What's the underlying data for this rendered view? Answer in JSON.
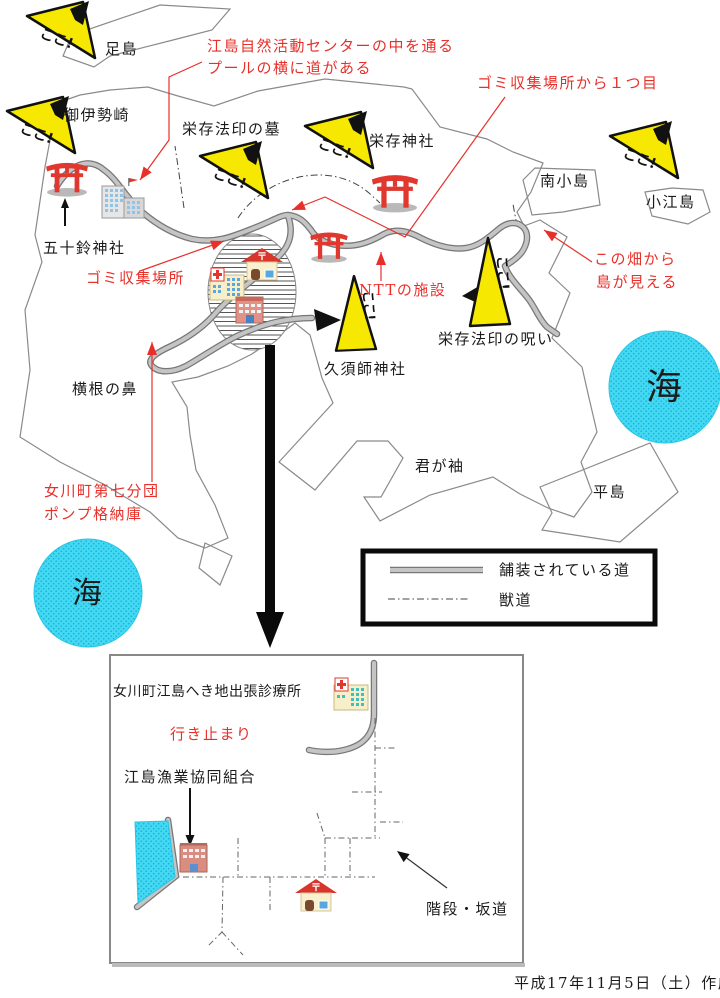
{
  "meta": {
    "created": "平成17年11月5日（土）作成"
  },
  "sea_label": "海",
  "flag_label": "ここ!",
  "post_mark": "〒",
  "legend": {
    "paved": "舗装されている道",
    "trail": "獣道"
  },
  "places": {
    "ashijima": "足島",
    "oisezaki": "御伊勢崎",
    "eizon_grave": "栄存法印の墓",
    "eizon_shrine": "栄存神社",
    "minami_kojima": "南小島",
    "koejima": "小江島",
    "isuzu_shrine": "五十鈴神社",
    "eizon_curse": "栄存法印の呪い",
    "kusushi_shrine": "久須師神社",
    "yokone_no_hana": "横根の鼻",
    "kimigasode": "君が袖",
    "heijima": "平島"
  },
  "annotations": {
    "center_note_1": "江島自然活動センターの中を通る",
    "center_note_2": "プールの横に道がある",
    "garbage_first": "ゴミ収集場所から１つ目",
    "garbage_site": "ゴミ収集場所",
    "ntt": "NTTの施設",
    "field_view_1": "この畑から",
    "field_view_2": "島が見える",
    "pump_1": "女川町第七分団",
    "pump_2": "ポンプ格納庫"
  },
  "inset": {
    "clinic": "女川町江島へき地出張診療所",
    "dead_end": "行き止まり",
    "fishery": "江島漁業協同組合",
    "stairs": "階段・坂道"
  },
  "colors": {
    "sea": "#45d8f2",
    "sea_dot": "#0fb3d6",
    "flag_yellow": "#f6e800",
    "red": "#e8302a",
    "road_fill": "#c4c4c4",
    "road_edge": "#777777"
  }
}
